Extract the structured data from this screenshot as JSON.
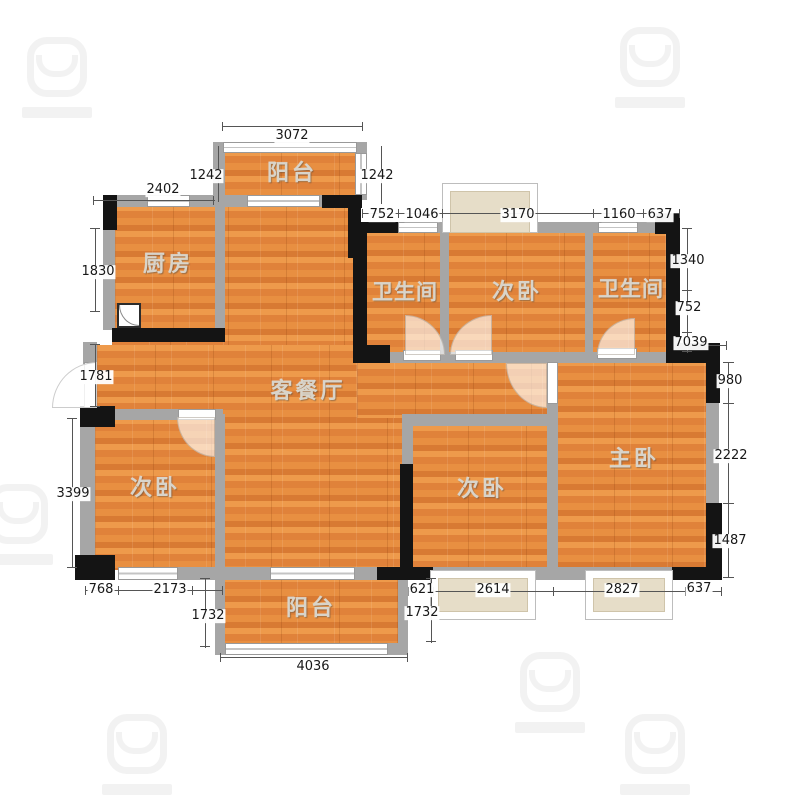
{
  "app": {
    "type": "residential-floor-plan",
    "background": "#ffffff"
  },
  "colors": {
    "floor_wood": "#e2873e",
    "wall_gray": "#a6a6a6",
    "wall_black": "#141414",
    "window": "#ffffff",
    "bay_window_fill": "#e6ddc8",
    "dimension_text": "#181818",
    "room_label_text": "#d9d4ca"
  },
  "rooms": [
    {
      "id": "balcony-top",
      "label": "阳台"
    },
    {
      "id": "kitchen",
      "label": "厨房"
    },
    {
      "id": "bathroom-left",
      "label": "卫生间"
    },
    {
      "id": "bedroom-top",
      "label": "次卧"
    },
    {
      "id": "bathroom-right",
      "label": "卫生间"
    },
    {
      "id": "living-dining",
      "label": "客餐厅"
    },
    {
      "id": "bedroom-left",
      "label": "次卧"
    },
    {
      "id": "bedroom-middle",
      "label": "次卧"
    },
    {
      "id": "master-bedroom",
      "label": "主卧"
    },
    {
      "id": "balcony-bottom",
      "label": "阳台"
    }
  ],
  "dims": [
    {
      "edge": "top",
      "v": "3072"
    },
    {
      "edge": "top-balcony-left",
      "v": "1242"
    },
    {
      "edge": "top-balcony-right",
      "v": "1242"
    },
    {
      "edge": "top-kitchen",
      "v": "2402"
    },
    {
      "edge": "top-chain",
      "v": "752"
    },
    {
      "edge": "top-chain",
      "v": "1046"
    },
    {
      "edge": "top-chain",
      "v": "3170"
    },
    {
      "edge": "top-chain",
      "v": "1160"
    },
    {
      "edge": "top-chain",
      "v": "637"
    },
    {
      "edge": "left",
      "v": "1830"
    },
    {
      "edge": "left",
      "v": "1781"
    },
    {
      "edge": "left",
      "v": "3399"
    },
    {
      "edge": "right-inner",
      "v": "1340"
    },
    {
      "edge": "right-inner",
      "v": "752"
    },
    {
      "edge": "right-inner",
      "v": "7039"
    },
    {
      "edge": "right-outer",
      "v": "980"
    },
    {
      "edge": "right-outer",
      "v": "2222"
    },
    {
      "edge": "right-outer",
      "v": "1487"
    },
    {
      "edge": "bottom",
      "v": "768"
    },
    {
      "edge": "bottom",
      "v": "2173"
    },
    {
      "edge": "bottom-balcony-left",
      "v": "1732"
    },
    {
      "edge": "bottom",
      "v": "621"
    },
    {
      "edge": "bottom",
      "v": "2614"
    },
    {
      "edge": "bottom",
      "v": "2827"
    },
    {
      "edge": "bottom",
      "v": "637"
    },
    {
      "edge": "bottom-balcony-right",
      "v": "1732"
    },
    {
      "edge": "bottom-balcony",
      "v": "4036"
    }
  ]
}
